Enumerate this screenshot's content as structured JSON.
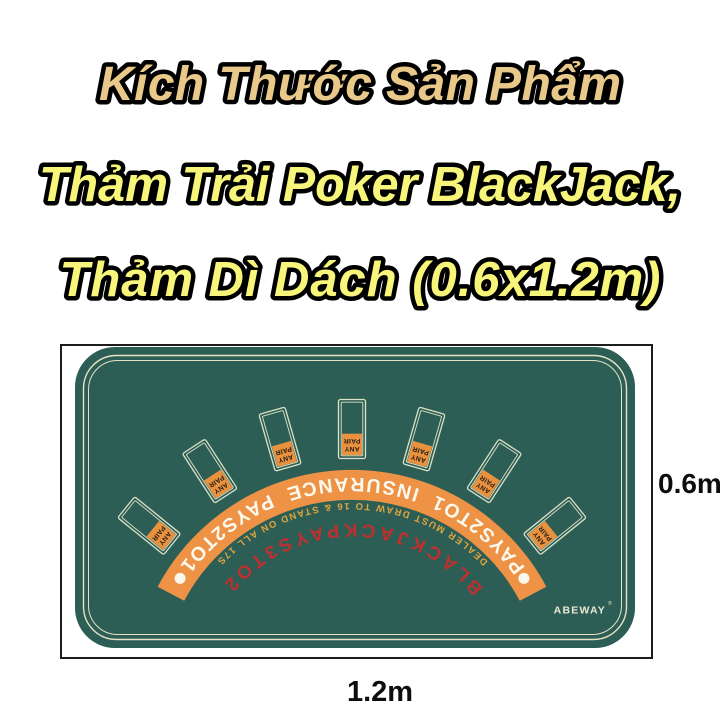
{
  "title": {
    "line1": "Kích Thước Sản Phẩm",
    "line2": "Thảm Trải Poker BlackJack,",
    "line3": "Thảm Dì Dách (0.6x1.2m)"
  },
  "mat": {
    "band_text": "PAYS2TO1 INSURANCE PAYS2TO1",
    "dealer_text": "DEALER MUST DRAW TO 16 & STAND ON ALL 17S",
    "blackjack_text": "BLACKJACKPAYS3TO2",
    "badge_line1": "ANY",
    "badge_line2": "PAIR",
    "brand": "ABEWAY",
    "brand_mark": "®",
    "card_spot_count": 7
  },
  "dimensions": {
    "height_label": "0.6m",
    "width_label": "1.2m"
  },
  "colors": {
    "mat_green": "#2d5e55",
    "band_orange": "#ee9245",
    "badge_orange": "#e8913e",
    "blackjack_red": "#c02e2d",
    "dealer_gold": "#dfa53f",
    "line_cream": "#e6e3c5",
    "title_tan": "#e9c98a",
    "title_yellow": "#f8f67a"
  }
}
